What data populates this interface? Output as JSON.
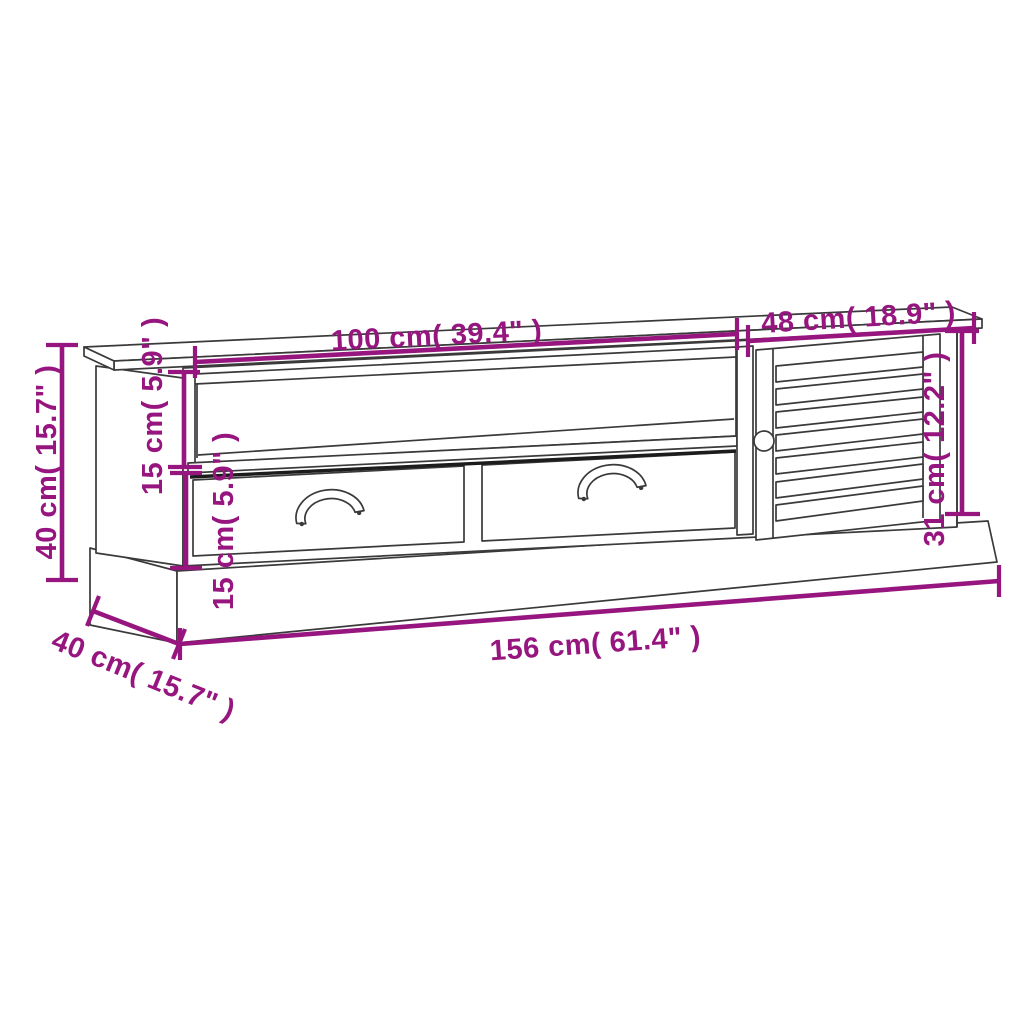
{
  "colors": {
    "dimension": "#97157F",
    "line_art": "#3A3A3A",
    "background": "#FFFFFF"
  },
  "dimensions": {
    "left_section_width": "100 cm( 39.4\" )",
    "right_section_width": "48 cm( 18.9\" )",
    "overall_height": "40 cm( 15.7\" )",
    "shelf_opening_height": "15 cm( 5.9\" )",
    "drawer_section_height": "15 cm( 5.9\" )",
    "door_height": "31 cm( 12.2\" )",
    "overall_width": "156 cm( 61.4\" )",
    "depth": "40 cm( 15.7\" )"
  }
}
